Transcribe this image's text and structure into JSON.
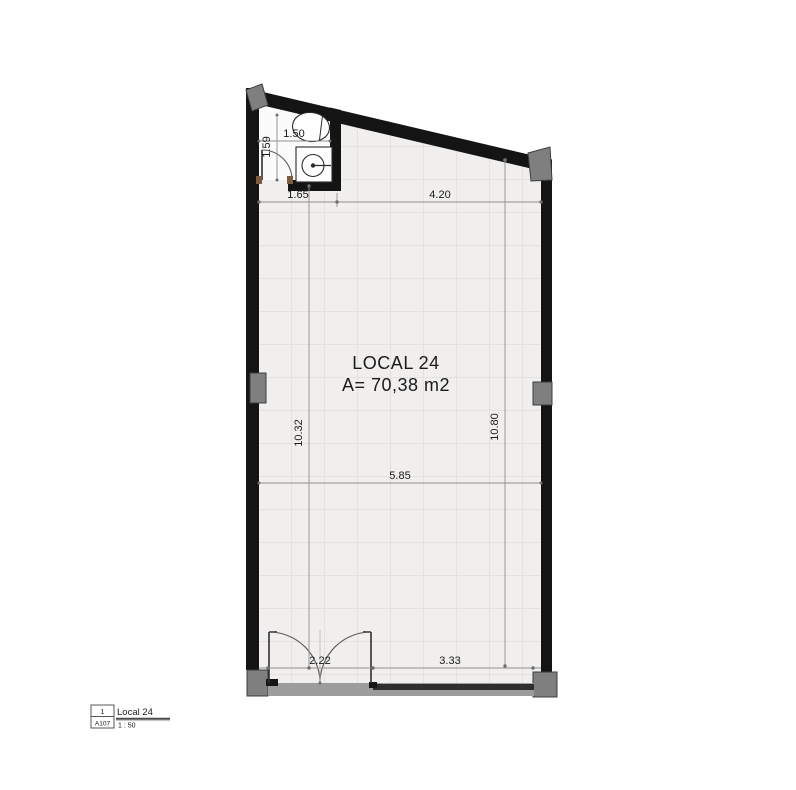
{
  "plan": {
    "room": {
      "name": "LOCAL 24",
      "area": "A= 70,38 m2"
    },
    "dimensions": {
      "bath_depth": "1.59",
      "bath_width": "1.50",
      "top_seg_left": "1.65",
      "top_seg_right": "4.20",
      "interior_height_left": "10.32",
      "interior_height_right": "10.80",
      "interior_width": "5.85",
      "entry_door_width": "2.22",
      "storefront_width": "3.33"
    }
  },
  "title_block": {
    "view_number": "1",
    "sheet_ref": "A107",
    "view_name": "Local 24",
    "scale": "1 : 50"
  },
  "colors": {
    "wall": "#141414",
    "column_fill": "#7f7f7f",
    "floor_fill": "#f0efee",
    "floor_grid": "#e3e2e0",
    "glazing": "#2e2e2e",
    "dimension_line": "#8f8f8f",
    "door_frame": "#7d5c3e"
  }
}
